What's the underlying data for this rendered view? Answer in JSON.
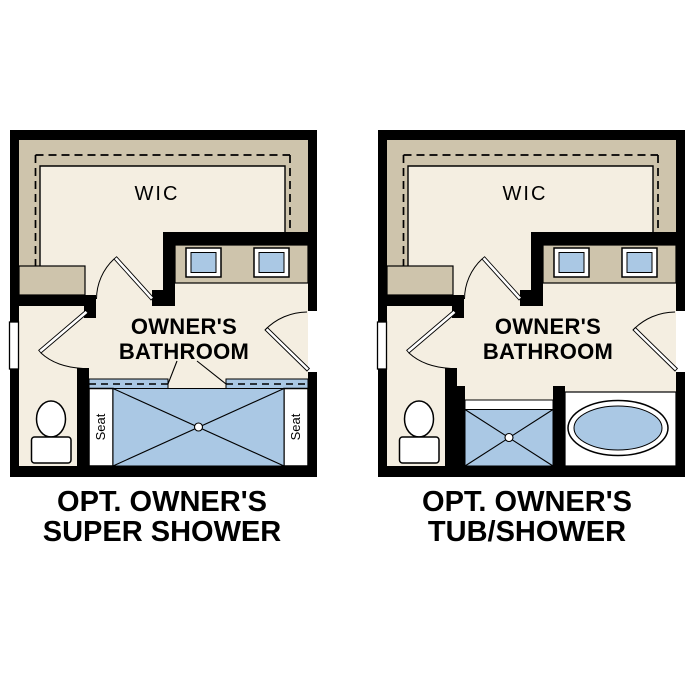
{
  "colors": {
    "background": "#ffffff",
    "wall": "#000000",
    "floor": "#f4eee1",
    "band": "#cec4ac",
    "fixture_blue": "#aac8e4",
    "fixture_white": "#ffffff",
    "line": "#000000",
    "text": "#000000"
  },
  "plans": [
    {
      "id": "opt-owners-super-shower",
      "labels": {
        "wic": "WIC",
        "bathroom_line1": "OWNER'S",
        "bathroom_line2": "BATHROOM",
        "seat_left": "Seat",
        "seat_right": "Seat"
      },
      "title_line1": "OPT. OWNER'S",
      "title_line2": "SUPER SHOWER"
    },
    {
      "id": "opt-owners-tub-shower",
      "labels": {
        "wic": "WIC",
        "bathroom_line1": "OWNER'S",
        "bathroom_line2": "BATHROOM"
      },
      "title_line1": "OPT. OWNER'S",
      "title_line2": "TUB/SHOWER"
    }
  ]
}
